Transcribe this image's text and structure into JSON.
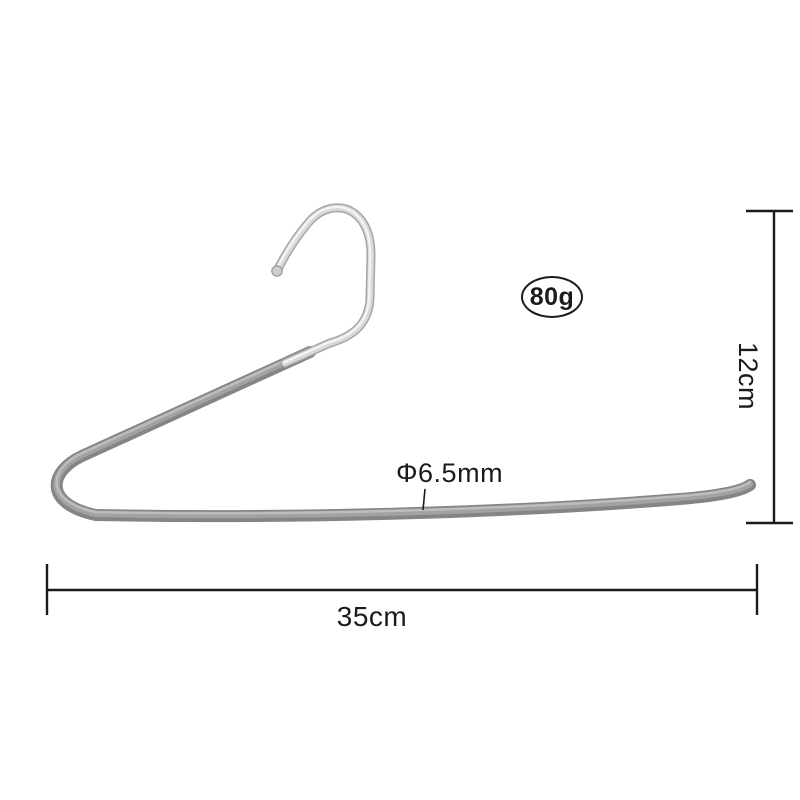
{
  "annotations": {
    "weight_badge": "80g",
    "diameter_label": "Φ6.5mm",
    "width_label": "35cm",
    "height_label": "12cm"
  },
  "colors": {
    "background": "#ffffff",
    "annotation": "#1b1b1b",
    "bar_base": "#858585",
    "bar_mid": "#a2a2a2",
    "bar_highlight": "#bdbdbd",
    "chrome_edge": "#a6a6a6",
    "chrome_base": "#d9d9d9",
    "chrome_highlight": "#f4f4f4",
    "ball_fill": "#cccccc",
    "ball_rim": "#9a9a9a"
  }
}
